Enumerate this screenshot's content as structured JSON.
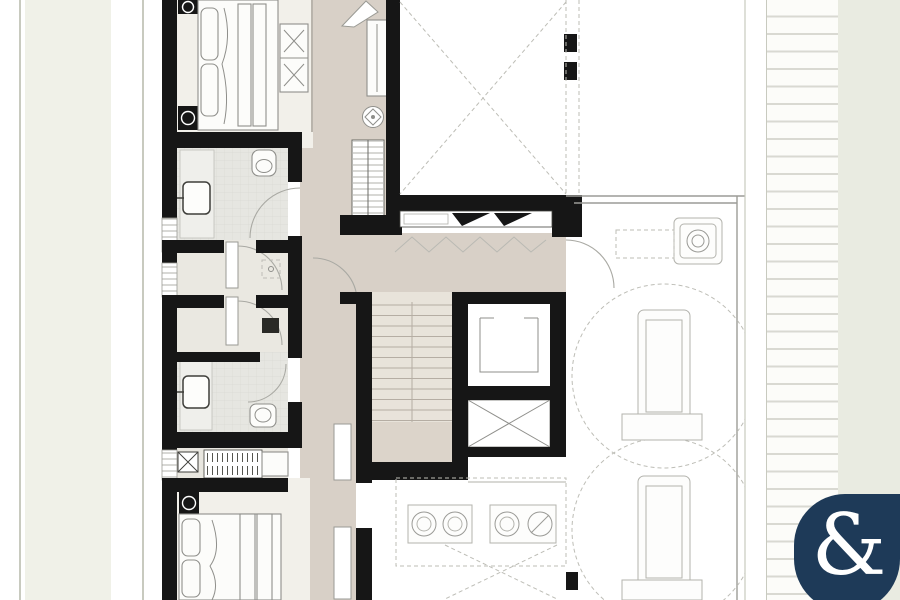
{
  "meta": {
    "kind": "architectural floor plan",
    "level": "penthouse upper floor with roof terrace"
  },
  "palette": {
    "wall": "#161616",
    "corridor_floor": "#d8d0c7",
    "bedroom_floor": "#f2f0ea",
    "bath_floor": "#e6e6e1",
    "wc_floor": "#eae8e1",
    "utility_floor": "#e9e7e0",
    "stair_floor": "#e8e3da",
    "stair_landing": "#dcd4ca",
    "terrace_line": "#9c9c97",
    "furniture_line": "#8f8f8b",
    "dash_line": "#bdbdb6",
    "outside_strip": "#f0f1e8",
    "outside_strip_right": "#e9ebe1",
    "edge_line": "#c8cabf",
    "slat_line": "#d9d9d2",
    "logo_bg": "#1e3a58",
    "logo_fg": "#ffffff"
  },
  "logo": {
    "glyph": "&"
  }
}
